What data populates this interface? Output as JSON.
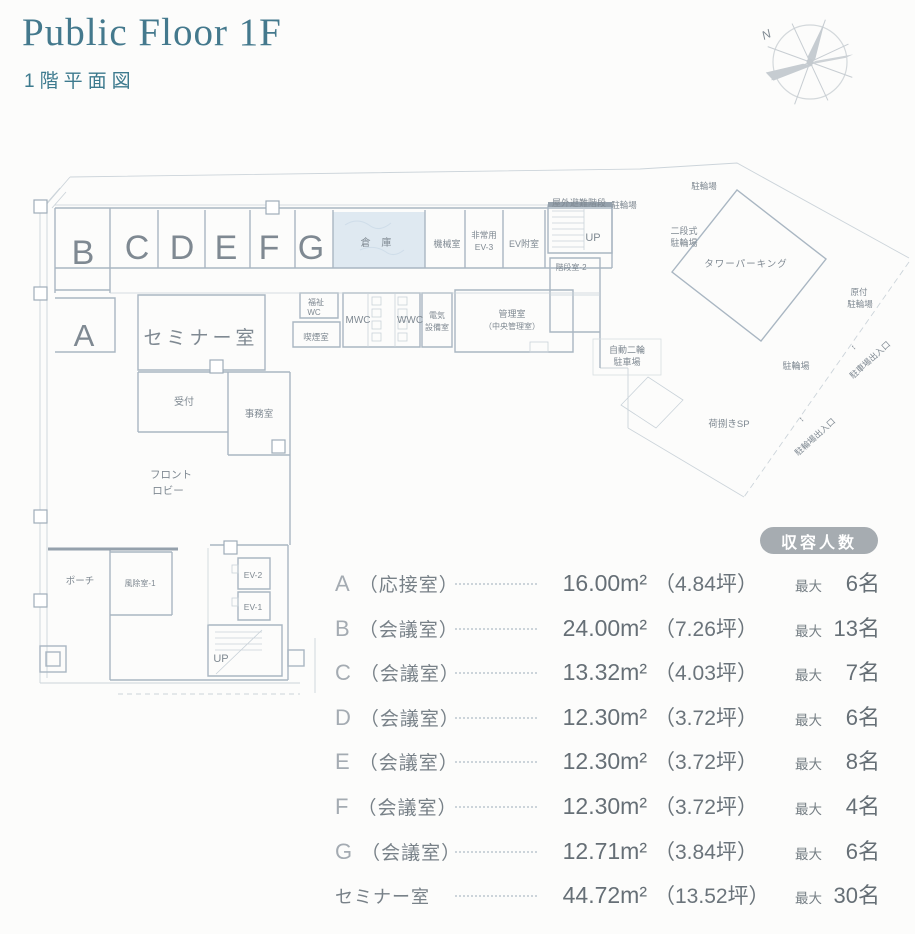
{
  "header": {
    "title": "Public Floor 1F",
    "subtitle": "1階平面図",
    "compass_n": "N"
  },
  "colors": {
    "accent_teal": "#44798d",
    "plan_line": "#a9b6c2",
    "plan_line_light": "#ccd4da",
    "plan_text": "#7f8992",
    "room_letter": "#99a2aa",
    "value_gray": "#666f76",
    "badge_bg": "#a6acb1",
    "storage_fill": "#dfe9f1"
  },
  "legend": {
    "badge": "収容人数",
    "rows": [
      {
        "label": "A",
        "name": "（応接室）",
        "area": "16.00m²",
        "tsubo": "（4.84坪）",
        "max": "最大",
        "capacity": "6名"
      },
      {
        "label": "B",
        "name": "（会議室）",
        "area": "24.00m²",
        "tsubo": "（7.26坪）",
        "max": "最大",
        "capacity": "13名"
      },
      {
        "label": "C",
        "name": "（会議室）",
        "area": "13.32m²",
        "tsubo": "（4.03坪）",
        "max": "最大",
        "capacity": "7名"
      },
      {
        "label": "D",
        "name": "（会議室）",
        "area": "12.30m²",
        "tsubo": "（3.72坪）",
        "max": "最大",
        "capacity": "6名"
      },
      {
        "label": "E",
        "name": "（会議室）",
        "area": "12.30m²",
        "tsubo": "（3.72坪）",
        "max": "最大",
        "capacity": "8名"
      },
      {
        "label": "F",
        "name": "（会議室）",
        "area": "12.30m²",
        "tsubo": "（3.72坪）",
        "max": "最大",
        "capacity": "4名"
      },
      {
        "label": "G",
        "name": "（会議室）",
        "area": "12.71m²",
        "tsubo": "（3.84坪）",
        "max": "最大",
        "capacity": "6名"
      },
      {
        "label": "セミナー室",
        "name": "",
        "area": "44.72m²",
        "tsubo": "（13.52坪）",
        "max": "最大",
        "capacity": "30名"
      }
    ]
  },
  "plan": {
    "labels": {
      "room_a": "A",
      "room_b": "B",
      "room_c": "C",
      "room_d": "D",
      "room_e": "E",
      "room_f": "F",
      "room_g": "G",
      "seminar": "セミナー室",
      "souko": "倉 庫",
      "kikai": "機械室",
      "hijo1": "非常用",
      "hijo2": "EV-3",
      "ev_fushitsu": "EV附室",
      "up_top": "UP",
      "okugai": "屋外避難階段",
      "churin_top1": "駐輪場",
      "kaidan2": "階段室-2",
      "churin_top2": "駐輪場",
      "nidan1": "二段式",
      "nidan2": "駐輪場",
      "tower": "タワーパーキング",
      "gentsuki1": "原付",
      "gentsuki2": "駐輪場",
      "churin_mid": "駐輪場",
      "jido1": "自動二輪",
      "jido2": "駐車場",
      "nisabaki": "荷捌きSP",
      "deiri_parking": "駐車場出入口",
      "deiri_churin": "駐輪場出入口",
      "arrows": "↕",
      "fukushi1": "福祉",
      "fukushi2": "WC",
      "kitsuen": "喫煙室",
      "mwc": "MWC",
      "wwc": "WWC",
      "denki1": "電気",
      "denki2": "設備室",
      "kanri1": "管理室",
      "kanri2": "（中央管理室）",
      "uketsuke": "受付",
      "jimu": "事務室",
      "lobby1": "フロント",
      "lobby2": "ロビー",
      "porch": "ポーチ",
      "fujo1": "風除室-1",
      "ev2": "EV-2",
      "ev1": "EV-1",
      "up_bottom": "UP"
    }
  }
}
